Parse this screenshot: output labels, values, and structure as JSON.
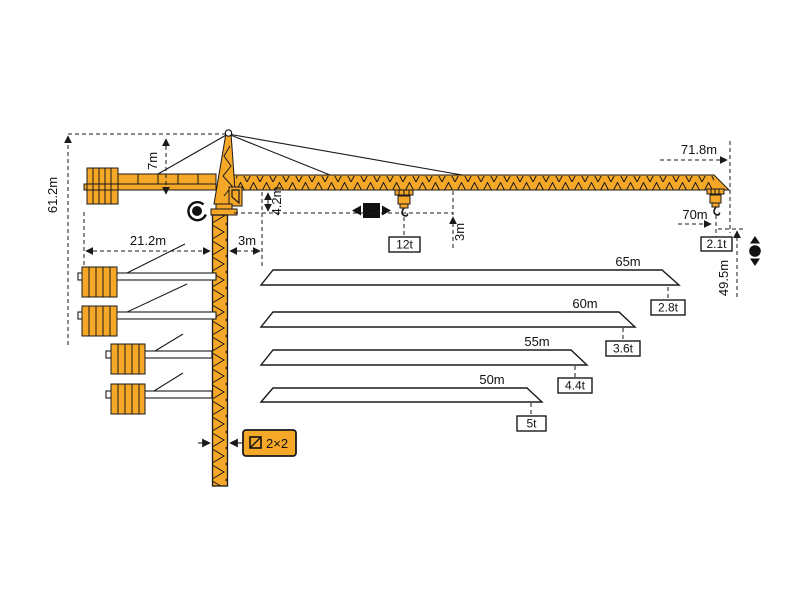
{
  "diagram": {
    "labels": {
      "tower_height": "61.2m",
      "apex_height": "7m",
      "counterjib_radius": "21.2m",
      "min_radius": "3m",
      "jib_depth": "4.2m",
      "max_load_radius": "3m",
      "max_load": "12t",
      "tip_radius": "71.8m",
      "max_hook_radius": "70m",
      "tip_load": "2.1t",
      "hook_height": "49.5m",
      "tower_section": "2×2"
    },
    "jib_variants": [
      {
        "length": "65m",
        "tip_load": "2.8t"
      },
      {
        "length": "60m",
        "tip_load": "3.6t"
      },
      {
        "length": "55m",
        "tip_load": "4.4t"
      },
      {
        "length": "50m",
        "tip_load": "5t"
      }
    ],
    "icons": [
      "slewing-icon",
      "trolley-travel-icon",
      "hoisting-icon",
      "tower-section-icon"
    ],
    "colors": {
      "crane": "#F5A728",
      "outline": "#1a1a1a",
      "background": "#ffffff"
    }
  }
}
